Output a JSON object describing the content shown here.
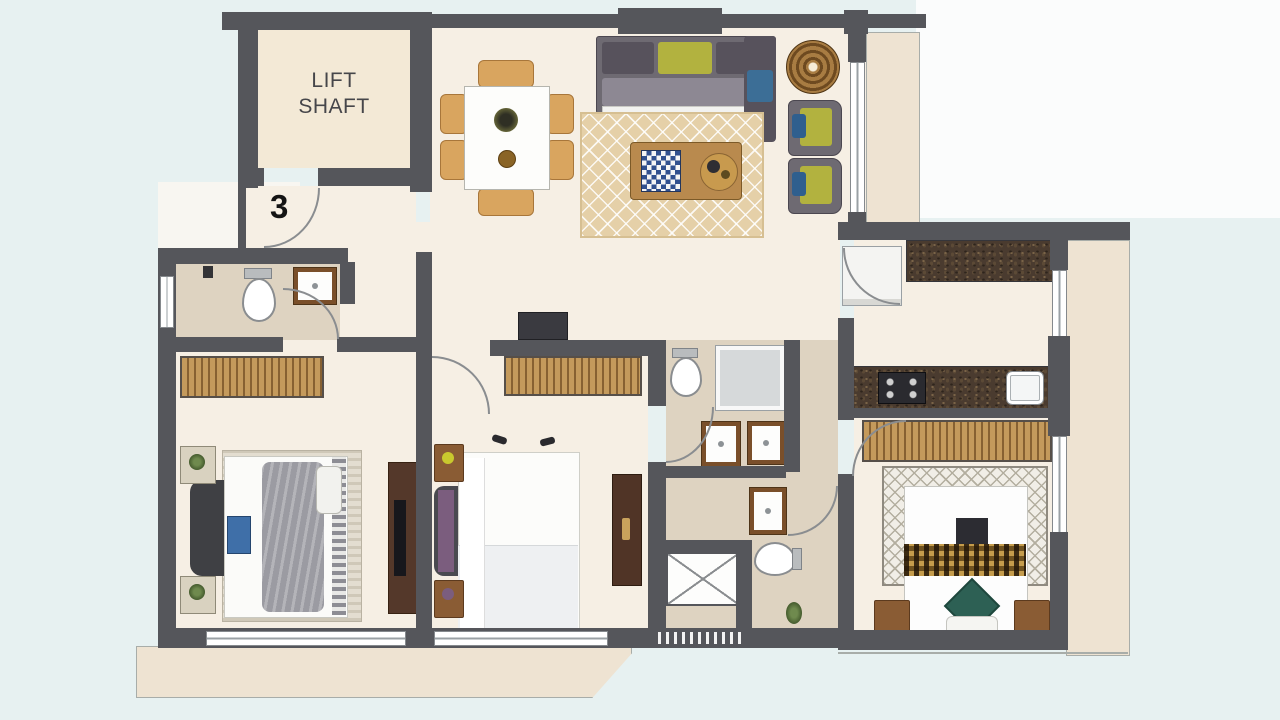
{
  "labels": {
    "lift_shaft": "LIFT SHAFT",
    "unit_number": "3"
  },
  "palette": {
    "background": "#e7f1f1",
    "paper_white": "#fbfcfc",
    "wall": "#55565b",
    "floor_cream": "#f6efe4",
    "floor_bath": "#ded3c1",
    "lift_floor": "#f3e9d6",
    "deck": "#eee3d2",
    "wardrobe_wood": "#c49a5c",
    "counter_granite": "#4a3b2f",
    "rug_tan": "#e5d0a8",
    "sofa_gray": "#6e6a72",
    "accent_yellow_green": "#b2b23f",
    "accent_blue": "#3c6e96",
    "accent_teal": "#2d6054",
    "accent_purple": "#7b5d7e",
    "wood_brown": "#8a5c34"
  },
  "rooms": [
    "lift-shaft",
    "entrance-foyer",
    "living-dining",
    "kitchen",
    "bedroom-left",
    "bedroom-middle",
    "master-bedroom",
    "bathroom-top-left",
    "common-bathroom",
    "master-bathroom",
    "utility-shaft",
    "deck-right",
    "deck-bottom",
    "deck-living"
  ],
  "fixtures": [
    "sofa",
    "chaise-lounge",
    "armchair",
    "round-side-table",
    "coffee-table",
    "chessboard",
    "dining-table",
    "dining-chair",
    "area-rug",
    "double-bed",
    "wardrobe",
    "tv-unit",
    "bedside-table",
    "toilet",
    "wash-basin",
    "shower",
    "refrigerator",
    "hob",
    "kitchen-sink",
    "kitchen-counter",
    "plant"
  ]
}
